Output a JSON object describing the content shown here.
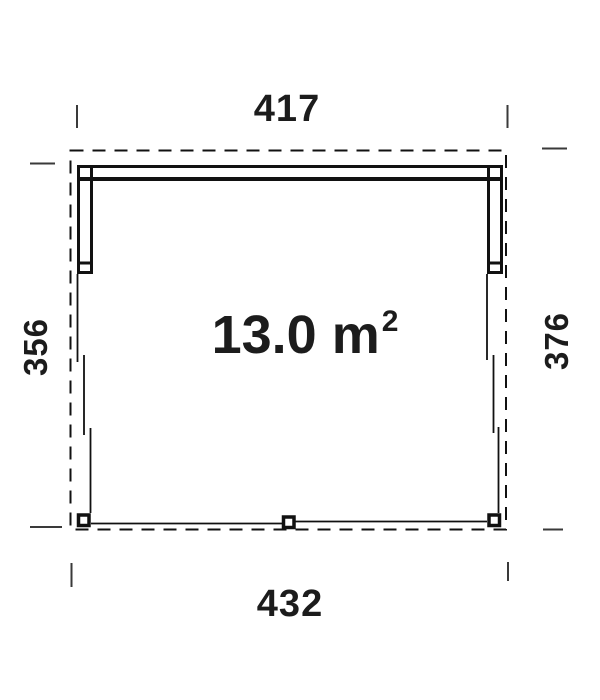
{
  "plan": {
    "area": {
      "main": "13.0 m",
      "superscript": "2"
    },
    "dim_top": "417",
    "dim_bottom": "432",
    "dim_left": "356",
    "dim_right": "376"
  },
  "colors": {
    "line": "#111111",
    "tick": "#3a3a3a",
    "text": "#1c1c1c",
    "background": "#ffffff"
  }
}
